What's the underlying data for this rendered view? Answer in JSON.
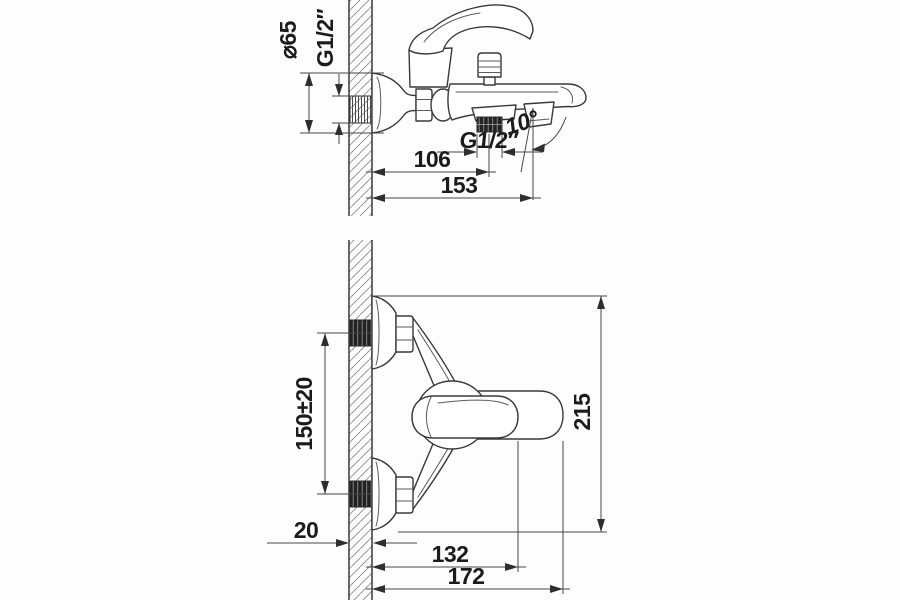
{
  "drawing": {
    "kind": "technical-installation-drawing",
    "subject": "wall-mounted single-lever bath mixer faucet, two orthographic views",
    "colors": {
      "background": "#fdfdfd",
      "line": "#3a3a3a",
      "text": "#1b1b1b",
      "thread_fill": "#232323",
      "wall_hatch": "#8a8a8a"
    },
    "views": {
      "side": {
        "dimensions": {
          "flange_diameter": "⌀65",
          "inlet_thread": "G1/2″",
          "outlet_thread": "G1/2″",
          "outlet_projection": "106",
          "spout_projection": "153",
          "spout_angle": "10°"
        }
      },
      "plan": {
        "dimensions": {
          "inlet_spacing": "150±20",
          "overall_span": "215",
          "wall_thickness": "20",
          "handle_projection": "132",
          "overall_projection": "172"
        }
      }
    }
  }
}
